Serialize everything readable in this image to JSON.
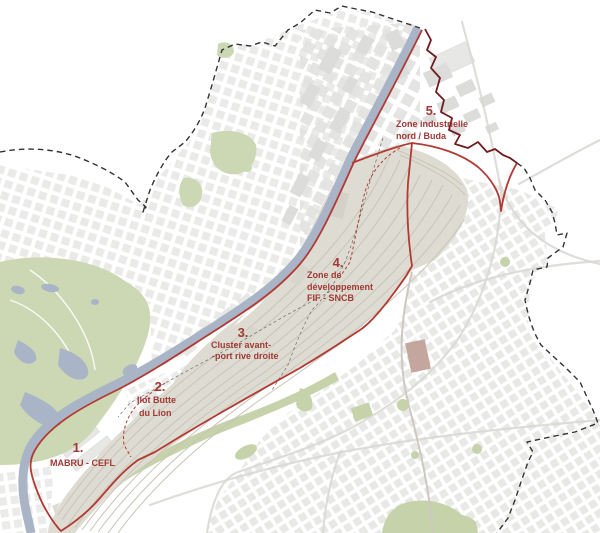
{
  "zones": [
    {
      "number": "1.",
      "lines": [
        "MABRU - CEFL"
      ]
    },
    {
      "number": "2.",
      "lines": [
        "Ilot Butte",
        "du Lion"
      ]
    },
    {
      "number": "3.",
      "lines": [
        "Cluster avant-",
        "-port rive droite"
      ]
    },
    {
      "number": "4.",
      "lines": [
        "Zone de",
        "développement",
        "FIF - SNCB"
      ]
    },
    {
      "number": "5.",
      "lines": [
        "Zone industrielle",
        "nord / Buda"
      ]
    }
  ],
  "colors": {
    "perimeter_red": "#b23a34",
    "zone5_dark_red": "#6f1d20",
    "label_red": "#a03936",
    "water_blue": "#a9b5c6",
    "park_green": "#ccd7b3",
    "band_green": "#c6d2a9",
    "rail_yard_beige": "#dedcd2",
    "track_beige": "#c8c5b6",
    "building_gray": "#e7e7e5",
    "road_gray": "#d8d7d2",
    "boundary_dash_black": "#333333"
  }
}
